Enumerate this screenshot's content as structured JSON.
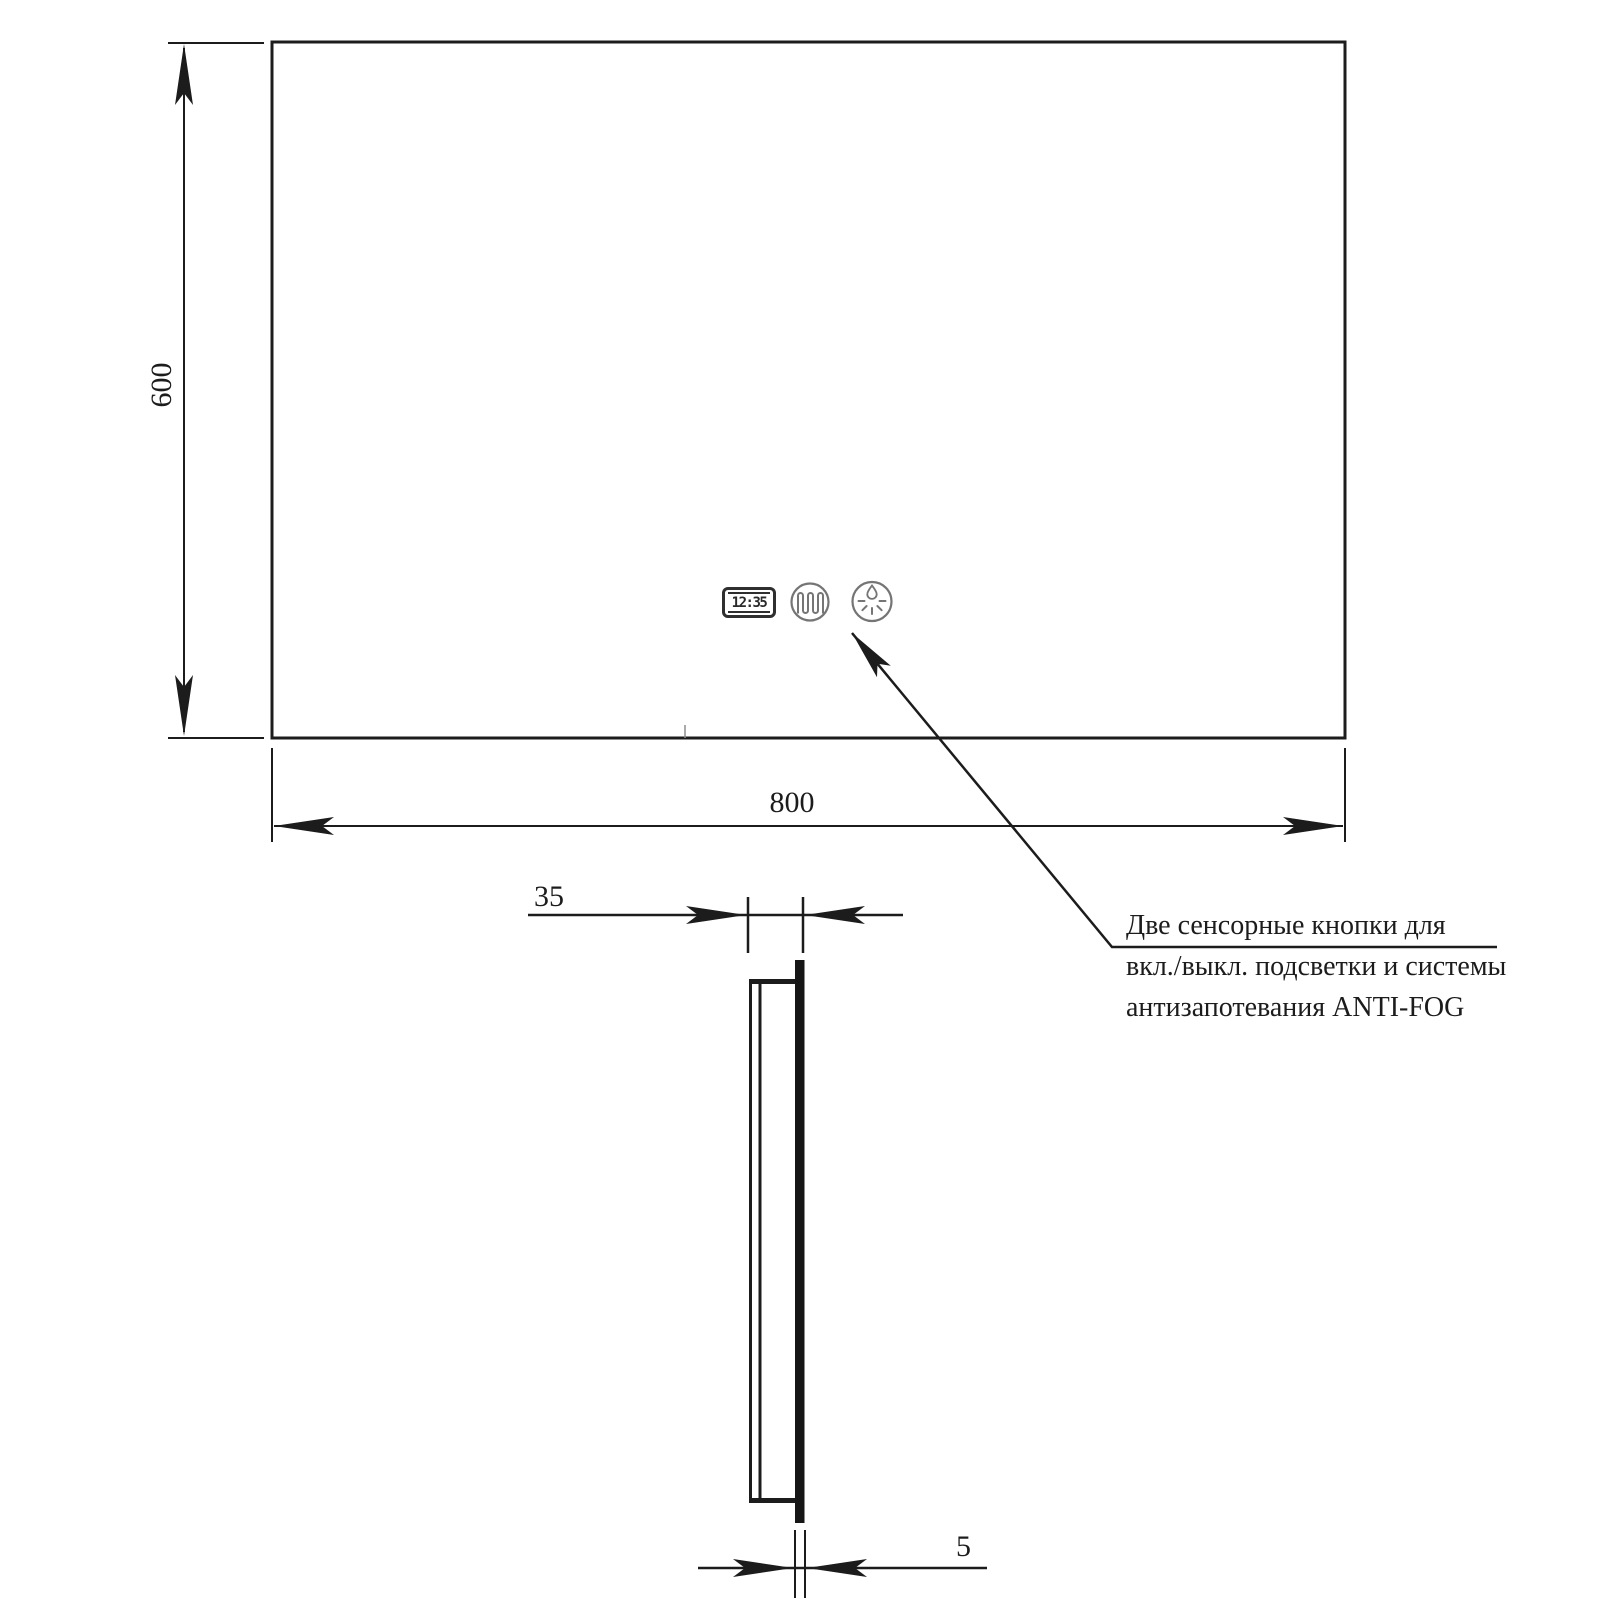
{
  "page": {
    "kind": "mirror technical dimension drawing",
    "background": "#ffffff"
  },
  "front_view": {
    "height_dim_label": "600",
    "width_dim_label": "800",
    "clock_display": "12:35"
  },
  "side_view": {
    "depth_dim_label": "35",
    "glass_thickness_dim_label": "5"
  },
  "annotation": {
    "line1": "Две сенсорные кнопки для",
    "line2": "вкл./выкл. подсветки и системы",
    "line3": "антизапотевания ANTI-FOG"
  },
  "icons": {
    "clock": "digital-clock-display",
    "heater_button": "heater-coil-icon",
    "backlight_button": "droplet-rays-icon"
  },
  "colors": {
    "line_color": "#1c1c1c",
    "icon_stroke": "#757575",
    "glass_fill": "#161616"
  }
}
